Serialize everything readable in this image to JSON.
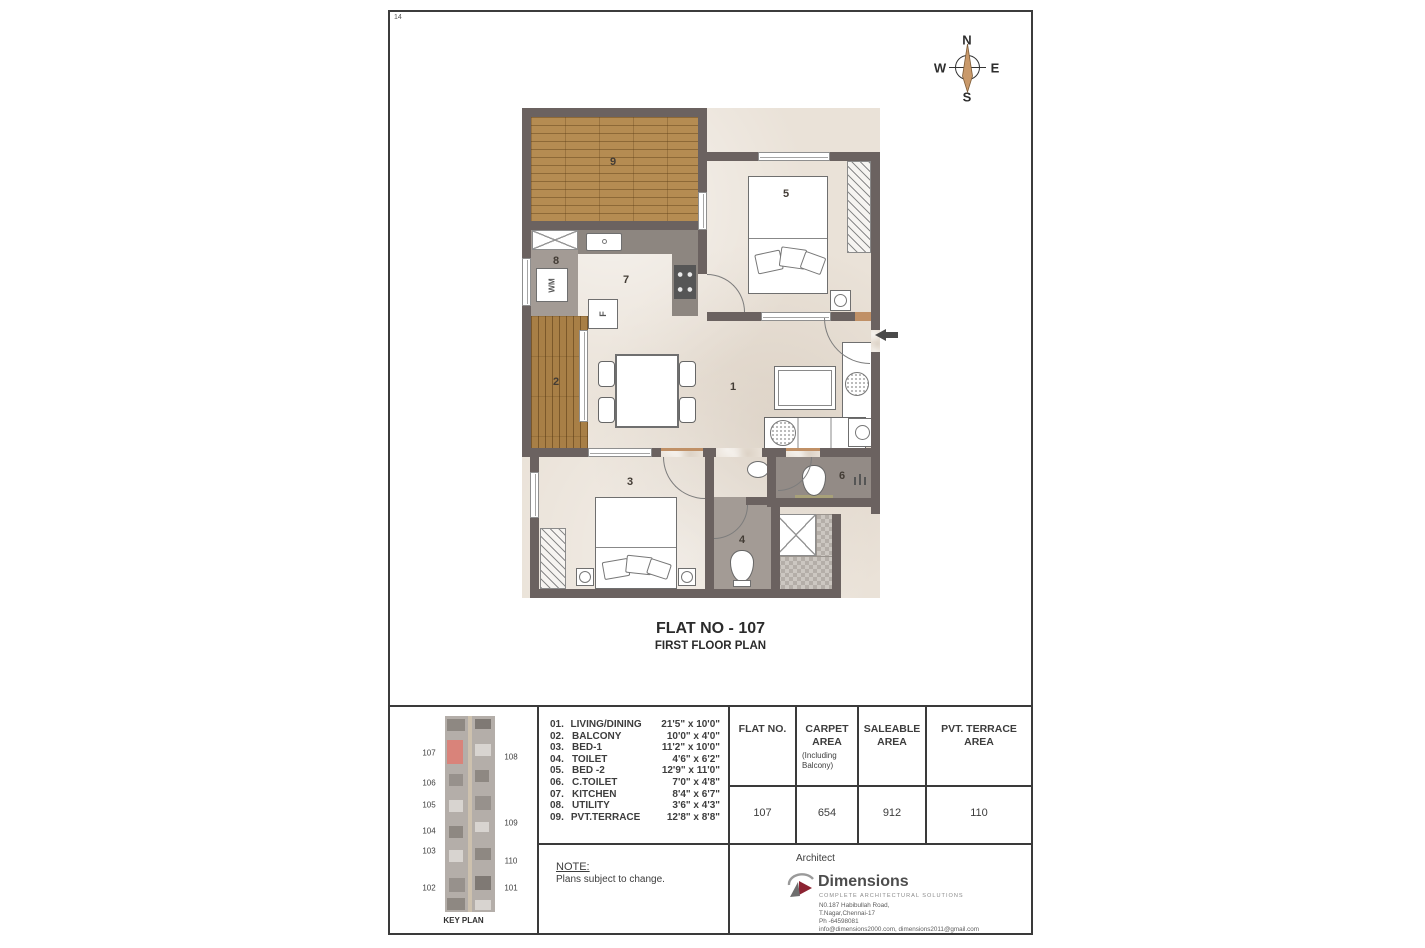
{
  "page": {
    "number": "14"
  },
  "compass": {
    "n": "N",
    "e": "E",
    "s": "S",
    "w": "W"
  },
  "title": {
    "flat": "FLAT NO - 107",
    "plan": "FIRST FLOOR PLAN"
  },
  "plan": {
    "room_labels": {
      "living": "1",
      "balcony": "2",
      "bed1": "3",
      "toilet": "4",
      "bed2": "5",
      "ctoilet": "6",
      "kitchen": "7",
      "utility": "8",
      "terrace": "9"
    },
    "wm_label": "WM",
    "fridge_label": "F"
  },
  "legend": {
    "rooms": [
      {
        "no": "01.",
        "name": "LIVING/DINING",
        "dim": "21'5\" x 10'0\""
      },
      {
        "no": "02.",
        "name": "BALCONY",
        "dim": "10'0\" x  4'0\""
      },
      {
        "no": "03.",
        "name": "BED-1",
        "dim": "11'2\" x 10'0\""
      },
      {
        "no": "04.",
        "name": "TOILET",
        "dim": "4'6\" x  6'2\""
      },
      {
        "no": "05.",
        "name": "BED -2",
        "dim": "12'9\" x 11'0\""
      },
      {
        "no": "06.",
        "name": "C.TOILET",
        "dim": "7'0\" x  4'8\""
      },
      {
        "no": "07.",
        "name": "KITCHEN",
        "dim": "8'4\" x  6'7\""
      },
      {
        "no": "08.",
        "name": "UTILITY",
        "dim": "3'6\" x  4'3\""
      },
      {
        "no": "09.",
        "name": "PVT.TERRACE",
        "dim": "12'8\" x  8'8\""
      }
    ]
  },
  "area_table": {
    "headers": {
      "flat_no": "FLAT NO.",
      "carpet": "CARPET AREA",
      "carpet_note": "(Including Balcony)",
      "saleable": "SALEABLE AREA",
      "terrace": "PVT. TERRACE AREA"
    },
    "row": {
      "flat_no": "107",
      "carpet": "654",
      "saleable": "912",
      "terrace": "110"
    }
  },
  "note": {
    "heading": "NOTE:",
    "text": "Plans subject to change."
  },
  "architect": {
    "label": "Architect",
    "firm": "Dimensions",
    "tagline": "COMPLETE ARCHITECTURAL SOLUTIONS",
    "address1": "N0.187 Habibullah Road,",
    "address2": "T.Nagar,Chennai-17",
    "phone": "Ph -64598081",
    "email": "info@dimensions2000.com, dimensions2011@gmail.com"
  },
  "keyplan": {
    "label": "KEY PLAN",
    "left": [
      "107",
      "106",
      "105",
      "104",
      "103",
      "102"
    ],
    "right": [
      "108",
      "109",
      "110",
      "101"
    ]
  },
  "colors": {
    "wall": "#6b6260",
    "wood_terrace": "#b58c52",
    "wood_balcony": "#a87f46",
    "keyplan_highlight": "#d9837a",
    "logo_maroon": "#8c2332"
  }
}
